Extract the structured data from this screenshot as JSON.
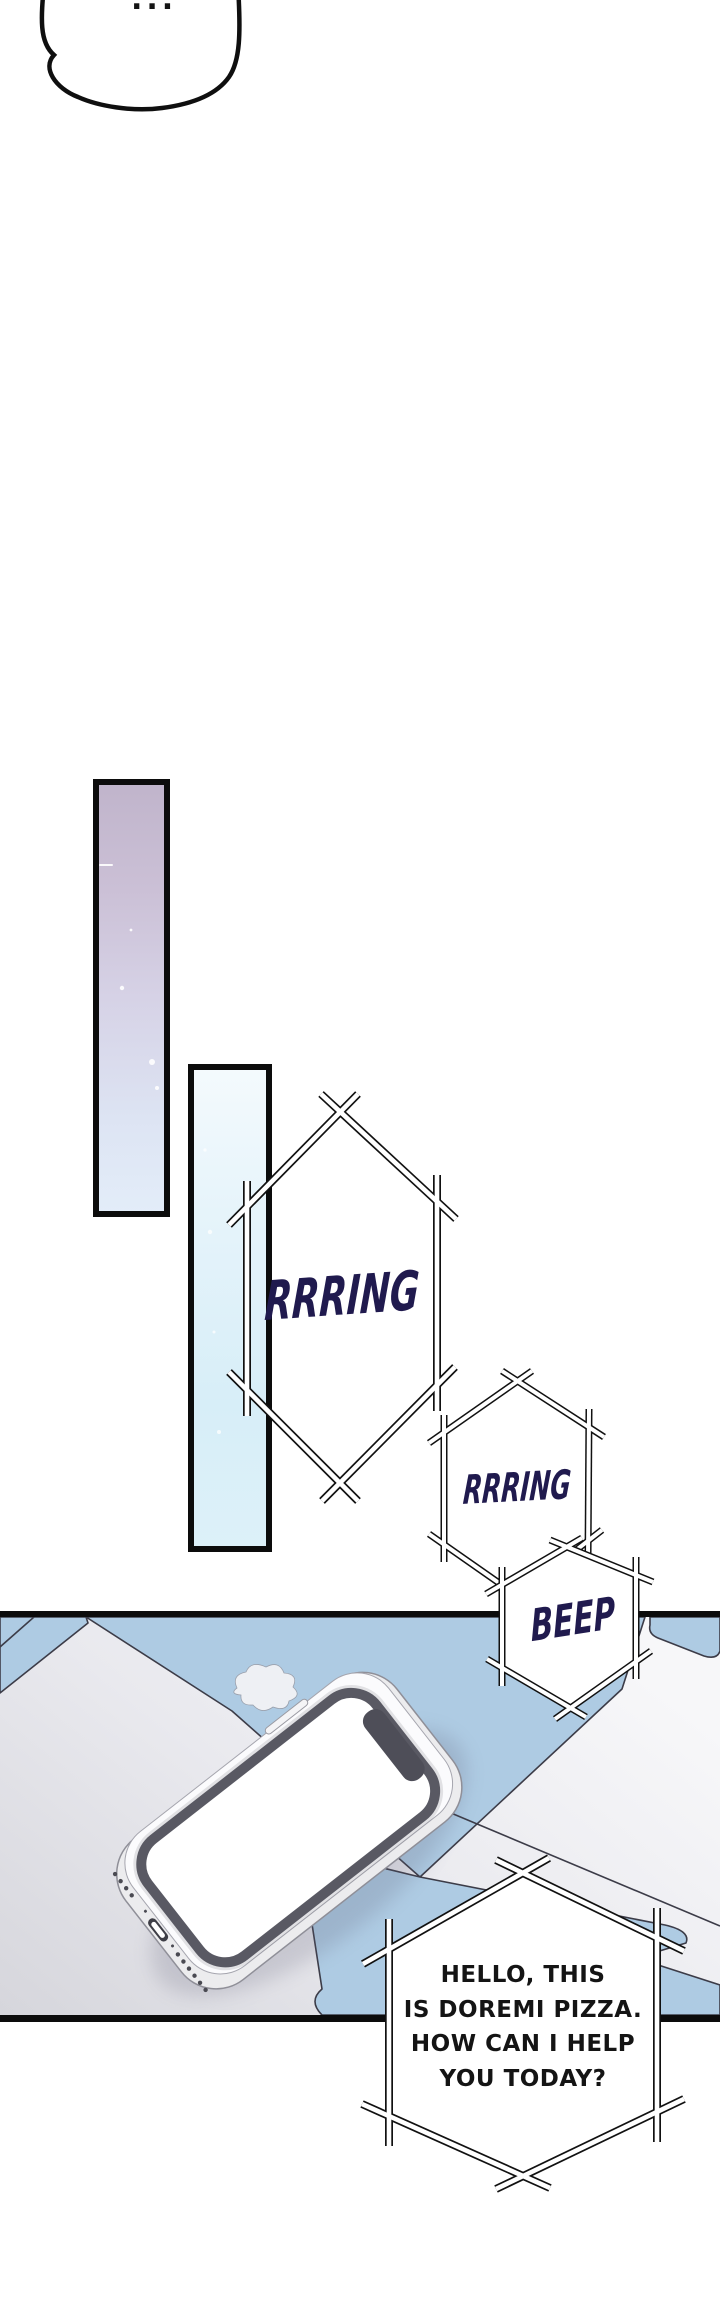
{
  "top_bubble": {
    "text": "..."
  },
  "sfx": {
    "ring_large": "RRRING",
    "ring_small": "RRRING",
    "beep": "BEEP",
    "text_color": "#201a4e"
  },
  "dialogue_bubble": {
    "lines": [
      "HELLO, THIS",
      "IS DOREMI PIZZA.",
      "HOW CAN I HELP",
      "YOU TODAY?"
    ],
    "text_color": "#141414"
  },
  "colors": {
    "page_background": "#ffffff",
    "panel_border": "#0c0c0c",
    "floor_tile_blue": "#aecbe3",
    "floor_tile_gray": "#dcdce2",
    "tile_seam": "#3c3c48",
    "bar_purple_top": "#c0b4cb",
    "bar_purple_bottom": "#e3edf9",
    "bar_blue_top": "#f4fafd",
    "bar_blue_bottom": "#ddf1f9",
    "bubble_outline": "#111111",
    "phone_body": "#fbfbfd",
    "phone_bezel": "#595963",
    "phone_screen": "#ffffff",
    "phone_notch": "#4e4e58"
  }
}
